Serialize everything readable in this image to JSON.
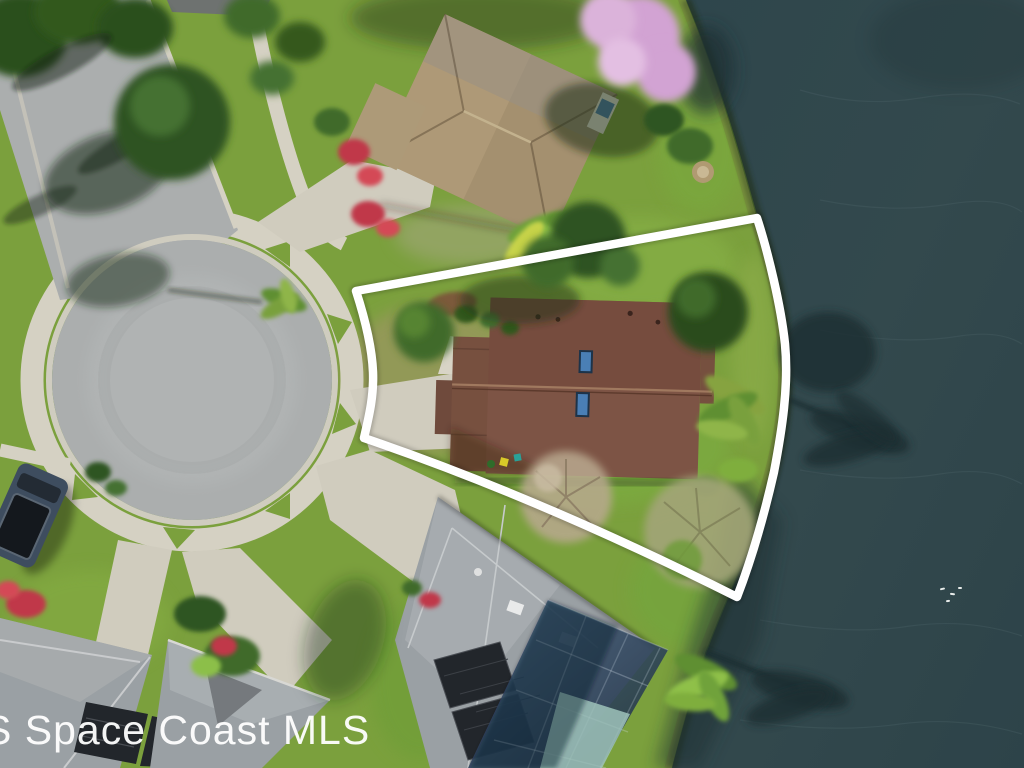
{
  "image": {
    "kind": "aerial-drone-photograph",
    "description": "Overhead aerial view of a lakefront single-family home on a cul-de-sac, subject lot traced with a white boundary outline, dark lake water on the right",
    "width": 1024,
    "height": 768
  },
  "watermark": {
    "text": "S Space Coast MLS"
  },
  "scene": {
    "lake": "pond / lake water",
    "subject_lot": "white outlined property with brown shingle roof and two skylights",
    "street": "cul-de-sac with concrete sidewalk ring and entry road from top-left",
    "neighbor_top": "tan-roof house with pink flowering tree",
    "neighbor_bottom": "gray-roof house with solar panels and screened pool enclosure",
    "neighbor_bottom_left": "gray-roof house with solar panels",
    "parked_vehicle": "dark pickup truck parked at curb",
    "birds": "small white birds on the water"
  },
  "colors": {
    "water": "#32494e",
    "grass_base": "#7ba03d",
    "asphalt": "#abaeae",
    "concrete": "#d5d1c3",
    "driveway": "#d0ccbe",
    "roof_subject": "#7d5445",
    "roof_neighbor_tan": "#a4906f",
    "roof_neighbor_gray": "#9aa0a4",
    "solar_panel": "#22262b",
    "outline_white": "#ffffff",
    "pink_tree": "#d2a3d3",
    "bougainvillea": "#c0394a",
    "pool_water": "#9fc3bb",
    "skylight": "#4a7fb5",
    "watermark": "rgba(255,255,255,0.95)"
  }
}
